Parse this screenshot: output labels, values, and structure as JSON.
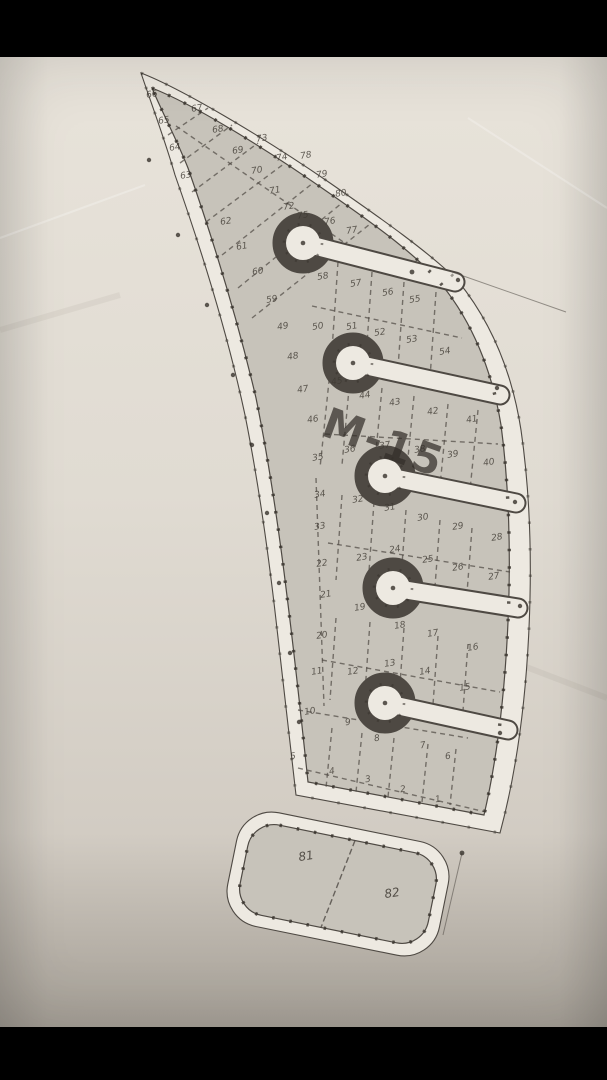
{
  "map": {
    "plan_label": "M-15",
    "colors": {
      "background": "#000000",
      "paper": "#e2ddd4",
      "lot_fill": "#c7c3ba",
      "road_fill": "#ede9e1",
      "line": "#4e4943",
      "tick": "#37322c",
      "label": "#3f3a33"
    },
    "lots": [
      {
        "n": "1",
        "x": 438,
        "y": 800
      },
      {
        "n": "2",
        "x": 403,
        "y": 790
      },
      {
        "n": "3",
        "x": 368,
        "y": 780
      },
      {
        "n": "4",
        "x": 332,
        "y": 772
      },
      {
        "n": "5",
        "x": 293,
        "y": 757
      },
      {
        "n": "6",
        "x": 448,
        "y": 757
      },
      {
        "n": "7",
        "x": 423,
        "y": 746
      },
      {
        "n": "8",
        "x": 377,
        "y": 739
      },
      {
        "n": "9",
        "x": 348,
        "y": 723
      },
      {
        "n": "10",
        "x": 310,
        "y": 712
      },
      {
        "n": "11",
        "x": 317,
        "y": 672
      },
      {
        "n": "12",
        "x": 353,
        "y": 672
      },
      {
        "n": "13",
        "x": 390,
        "y": 664
      },
      {
        "n": "14",
        "x": 425,
        "y": 672
      },
      {
        "n": "15",
        "x": 465,
        "y": 688
      },
      {
        "n": "16",
        "x": 473,
        "y": 648
      },
      {
        "n": "17",
        "x": 433,
        "y": 634
      },
      {
        "n": "18",
        "x": 400,
        "y": 626
      },
      {
        "n": "19",
        "x": 360,
        "y": 608
      },
      {
        "n": "20",
        "x": 322,
        "y": 636
      },
      {
        "n": "21",
        "x": 326,
        "y": 595
      },
      {
        "n": "22",
        "x": 322,
        "y": 564
      },
      {
        "n": "23",
        "x": 362,
        "y": 558
      },
      {
        "n": "24",
        "x": 395,
        "y": 550
      },
      {
        "n": "25",
        "x": 428,
        "y": 560
      },
      {
        "n": "26",
        "x": 458,
        "y": 568
      },
      {
        "n": "27",
        "x": 494,
        "y": 577
      },
      {
        "n": "28",
        "x": 497,
        "y": 538
      },
      {
        "n": "29",
        "x": 458,
        "y": 527
      },
      {
        "n": "30",
        "x": 423,
        "y": 518
      },
      {
        "n": "31",
        "x": 390,
        "y": 508
      },
      {
        "n": "32",
        "x": 358,
        "y": 500
      },
      {
        "n": "33",
        "x": 320,
        "y": 527
      },
      {
        "n": "34",
        "x": 320,
        "y": 495
      },
      {
        "n": "35",
        "x": 318,
        "y": 458
      },
      {
        "n": "36",
        "x": 350,
        "y": 450
      },
      {
        "n": "37",
        "x": 385,
        "y": 446
      },
      {
        "n": "38",
        "x": 420,
        "y": 450
      },
      {
        "n": "39",
        "x": 453,
        "y": 455
      },
      {
        "n": "40",
        "x": 489,
        "y": 463
      },
      {
        "n": "41",
        "x": 472,
        "y": 420
      },
      {
        "n": "42",
        "x": 433,
        "y": 412
      },
      {
        "n": "43",
        "x": 395,
        "y": 403
      },
      {
        "n": "44",
        "x": 365,
        "y": 396
      },
      {
        "n": "45",
        "x": 337,
        "y": 382
      },
      {
        "n": "46",
        "x": 313,
        "y": 420
      },
      {
        "n": "47",
        "x": 303,
        "y": 390
      },
      {
        "n": "48",
        "x": 293,
        "y": 357
      },
      {
        "n": "49",
        "x": 283,
        "y": 327
      },
      {
        "n": "50",
        "x": 318,
        "y": 327
      },
      {
        "n": "51",
        "x": 352,
        "y": 327
      },
      {
        "n": "52",
        "x": 380,
        "y": 333
      },
      {
        "n": "53",
        "x": 412,
        "y": 340
      },
      {
        "n": "54",
        "x": 445,
        "y": 352
      },
      {
        "n": "55",
        "x": 415,
        "y": 300
      },
      {
        "n": "56",
        "x": 388,
        "y": 293
      },
      {
        "n": "57",
        "x": 356,
        "y": 284
      },
      {
        "n": "58",
        "x": 323,
        "y": 277
      },
      {
        "n": "59",
        "x": 272,
        "y": 300
      },
      {
        "n": "60",
        "x": 258,
        "y": 272
      },
      {
        "n": "61",
        "x": 242,
        "y": 247
      },
      {
        "n": "62",
        "x": 226,
        "y": 222
      },
      {
        "n": "63",
        "x": 186,
        "y": 176
      },
      {
        "n": "64",
        "x": 175,
        "y": 148
      },
      {
        "n": "65",
        "x": 164,
        "y": 121
      },
      {
        "n": "66",
        "x": 152,
        "y": 95
      },
      {
        "n": "67",
        "x": 197,
        "y": 109
      },
      {
        "n": "68",
        "x": 218,
        "y": 130
      },
      {
        "n": "69",
        "x": 238,
        "y": 151
      },
      {
        "n": "70",
        "x": 257,
        "y": 171
      },
      {
        "n": "71",
        "x": 275,
        "y": 191
      },
      {
        "n": "72",
        "x": 289,
        "y": 207
      },
      {
        "n": "73",
        "x": 262,
        "y": 139
      },
      {
        "n": "74",
        "x": 282,
        "y": 158
      },
      {
        "n": "75",
        "x": 303,
        "y": 216
      },
      {
        "n": "76",
        "x": 330,
        "y": 222
      },
      {
        "n": "77",
        "x": 352,
        "y": 231
      },
      {
        "n": "78",
        "x": 306,
        "y": 156
      },
      {
        "n": "79",
        "x": 322,
        "y": 175
      },
      {
        "n": "80",
        "x": 341,
        "y": 194
      },
      {
        "n": "81",
        "x": 306,
        "y": 856,
        "big": true
      },
      {
        "n": "82",
        "x": 392,
        "y": 893,
        "big": true
      }
    ]
  }
}
